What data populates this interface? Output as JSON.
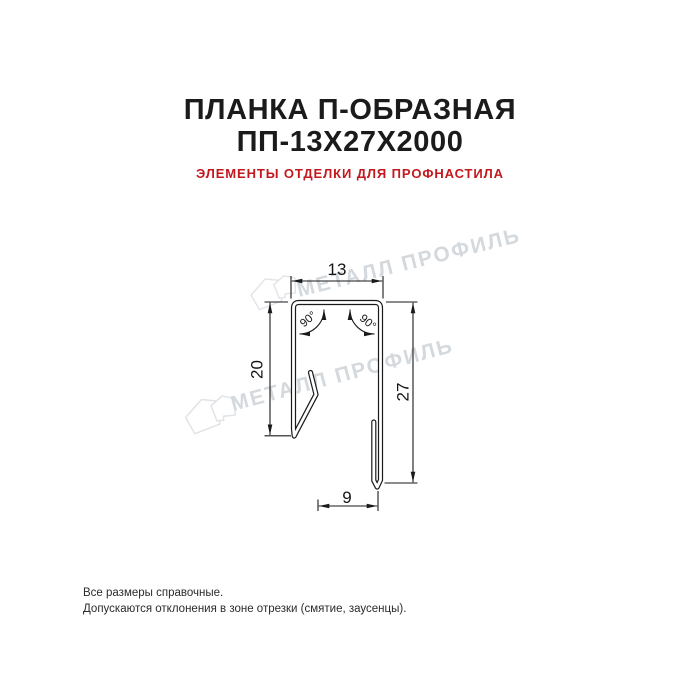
{
  "page": {
    "background": "#ffffff"
  },
  "header": {
    "title_line1": "ПЛАНКА П-ОБРАЗНАЯ",
    "title_line2": "ПП-13Х27Х2000",
    "subtitle": "ЭЛЕМЕНТЫ ОТДЕЛКИ ДЛЯ ПРОФНАСТИЛА",
    "title_color": "#1b1b1b",
    "subtitle_color": "#c2181e"
  },
  "drawing": {
    "type": "technical_cross_section",
    "line_color": "#1a1a1a",
    "dimensions": {
      "top_width": "13",
      "left_height": "20",
      "right_height": "27",
      "bottom_width": "9",
      "angle_left": "90°",
      "angle_right": "90°"
    }
  },
  "watermark": {
    "text": "МЕТАЛЛ ПРОФИЛЬ",
    "color": "#d4d9de",
    "logo_icon": "metall-profil-house-logo"
  },
  "footer": {
    "line1": "Все размеры справочные.",
    "line2": "Допускаются отклонения в зоне отрезки (смятие, заусенцы)."
  }
}
